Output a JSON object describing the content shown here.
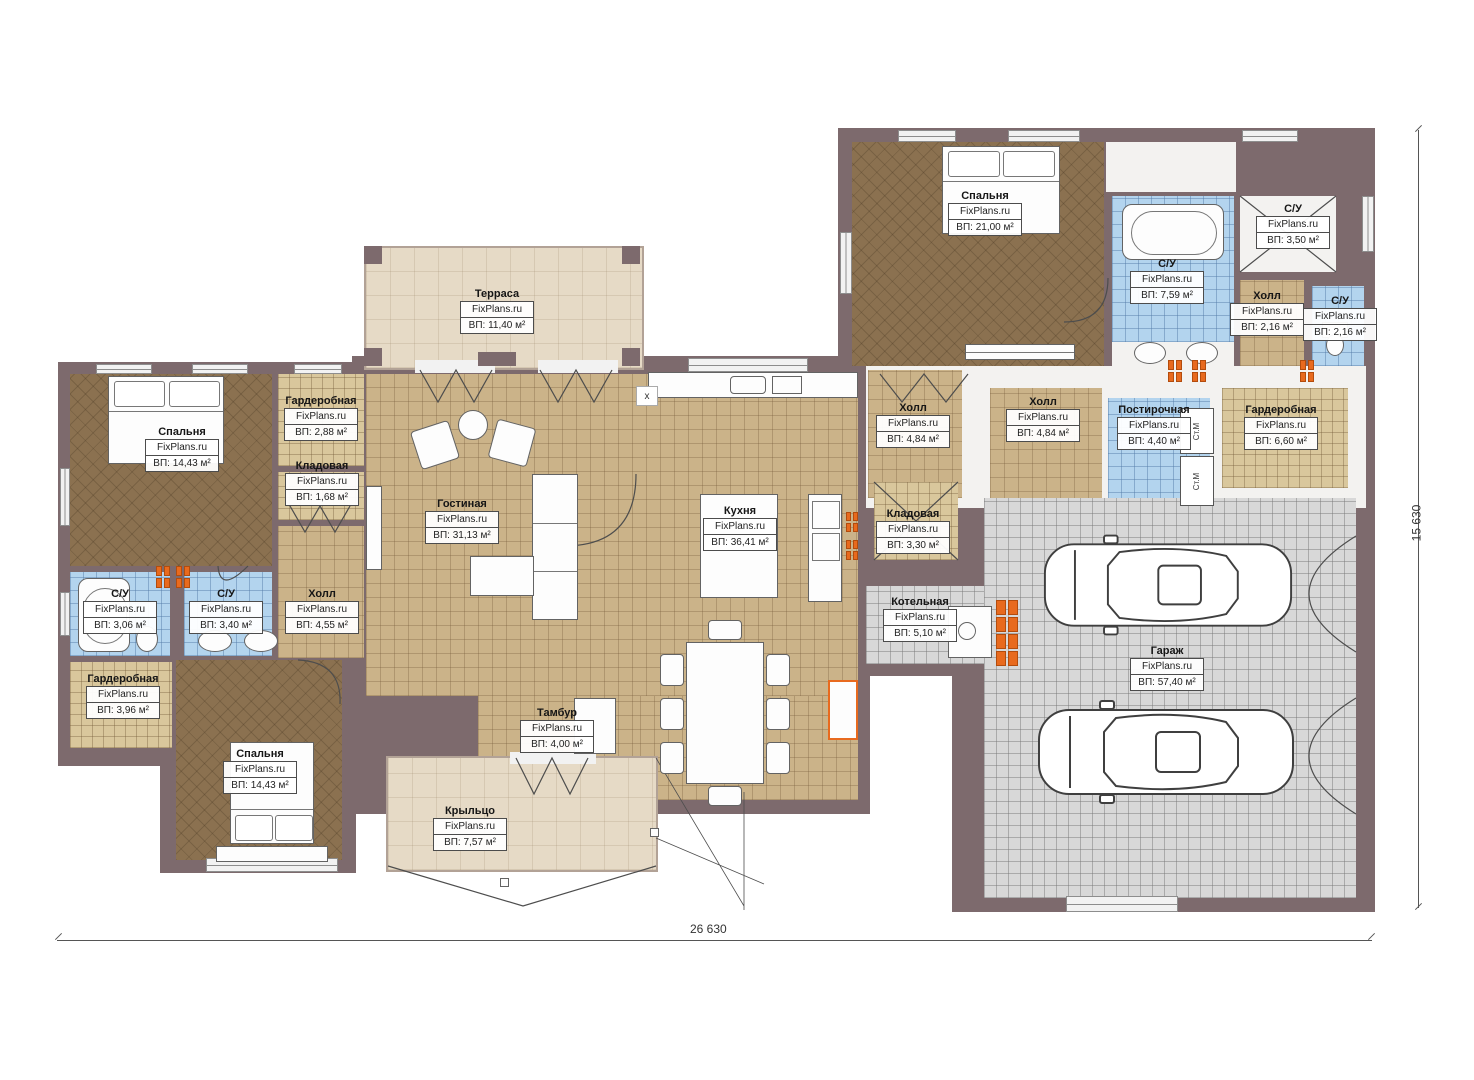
{
  "plan": {
    "watermark": "FixPlans.ru",
    "rooms": [
      {
        "name": "Спальня",
        "area": "ВП: 21,00 м²"
      },
      {
        "name": "С/У",
        "area": "ВП: 7,59 м²"
      },
      {
        "name": "С/У",
        "area": "ВП: 3,50 м²"
      },
      {
        "name": "Холл",
        "area": "ВП: 2,16 м²"
      },
      {
        "name": "С/У",
        "area": "ВП: 2,16 м²"
      },
      {
        "name": "Холл",
        "area": "ВП: 4,84 м²"
      },
      {
        "name": "Холл",
        "area": "ВП: 4,84 м²"
      },
      {
        "name": "Постирочная",
        "area": "ВП: 4,40 м²"
      },
      {
        "name": "Гардеробная",
        "area": "ВП: 6,60 м²"
      },
      {
        "name": "Кладовая",
        "area": "ВП: 3,30 м²"
      },
      {
        "name": "Котельная",
        "area": "ВП: 5,10 м²"
      },
      {
        "name": "Гараж",
        "area": "ВП: 57,40 м²"
      },
      {
        "name": "Терраса",
        "area": "ВП: 11,40 м²"
      },
      {
        "name": "Гостиная",
        "area": "ВП: 31,13 м²"
      },
      {
        "name": "Кухня",
        "area": "ВП: 36,41 м²"
      },
      {
        "name": "Тамбур",
        "area": "ВП: 4,00 м²"
      },
      {
        "name": "Крыльцо",
        "area": "ВП: 7,57 м²"
      },
      {
        "name": "Спальня",
        "area": "ВП: 14,43 м²"
      },
      {
        "name": "Гардеробная",
        "area": "ВП: 2,88 м²"
      },
      {
        "name": "Кладовая",
        "area": "ВП: 1,68 м²"
      },
      {
        "name": "Холл",
        "area": "ВП: 4,55 м²"
      },
      {
        "name": "С/У",
        "area": "ВП: 3,06 м²"
      },
      {
        "name": "С/У",
        "area": "ВП: 3,40 м²"
      },
      {
        "name": "Гардеробная",
        "area": "ВП: 3,96 м²"
      },
      {
        "name": "Спальня",
        "area": "ВП: 14,43 м²"
      }
    ],
    "dimensions": {
      "bottom": "26 630",
      "right": "15 630"
    },
    "annotations": {
      "washer": "Ст.М",
      "axis_x": "x"
    }
  }
}
